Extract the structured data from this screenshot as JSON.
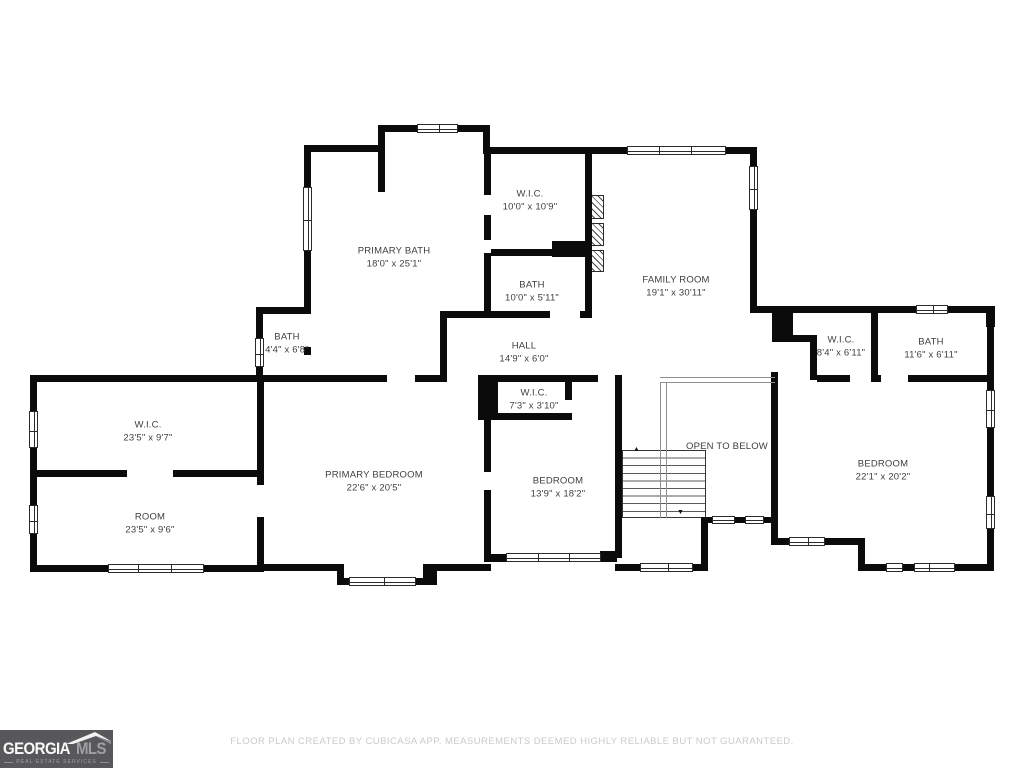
{
  "floor_plan": {
    "rooms": [
      {
        "name": "PRIMARY BATH",
        "dims": "18'0\" x 25'1\""
      },
      {
        "name": "W.I.C.",
        "dims": "10'0\" x 10'9\""
      },
      {
        "name": "BATH",
        "dims": "10'0\" x 5'11\""
      },
      {
        "name": "FAMILY ROOM",
        "dims": "19'1\" x 30'11\""
      },
      {
        "name": "BATH",
        "dims": "4'4\" x 6'8\""
      },
      {
        "name": "HALL",
        "dims": "14'9\" x 6'0\""
      },
      {
        "name": "W.I.C.",
        "dims": "8'4\" x 6'11\""
      },
      {
        "name": "BATH",
        "dims": "11'6\" x 6'11\""
      },
      {
        "name": "W.I.C.",
        "dims": "23'5\" x 9'7\""
      },
      {
        "name": "ROOM",
        "dims": "23'5\" x 9'6\""
      },
      {
        "name": "PRIMARY BEDROOM",
        "dims": "22'6\" x 20'5\""
      },
      {
        "name": "W.I.C.",
        "dims": "7'3\" x 3'10\""
      },
      {
        "name": "BEDROOM",
        "dims": "13'9\" x 18'2\""
      },
      {
        "name": "BEDROOM",
        "dims": "22'1\" x 20'2\""
      }
    ],
    "annotations": {
      "open_to_below": "OPEN TO BELOW"
    },
    "stairs": {
      "up_arrow": "▲",
      "down_arrow": "▼"
    }
  },
  "footer": {
    "disclaimer": "FLOOR PLAN CREATED BY CUBICASA APP. MEASUREMENTS DEEMED HIGHLY RELIABLE BUT NOT GUARANTEED."
  },
  "logo": {
    "brand_primary": "GEORGIA",
    "brand_secondary": "MLS",
    "tagline": "REAL ESTATE SERVICES"
  },
  "colors": {
    "wall": "#0b0b0b",
    "label_text": "#3f3f3f",
    "footer_text": "#c9cacb",
    "logo_bg": "#58585a",
    "logo_secondary": "#9fa0a2"
  }
}
